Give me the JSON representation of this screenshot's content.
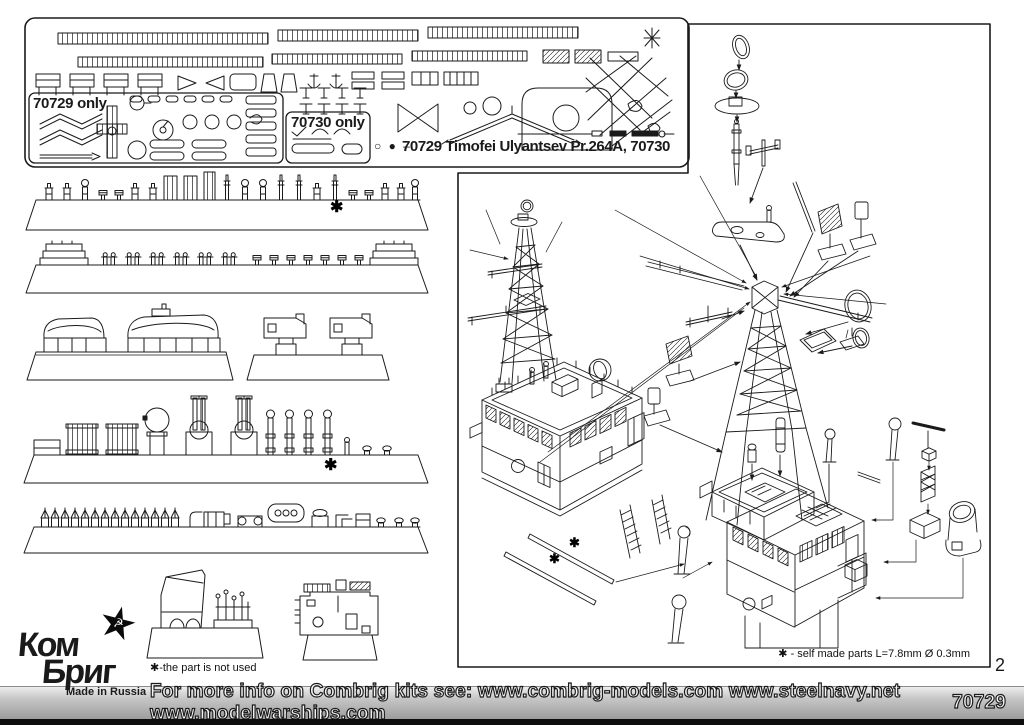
{
  "document": {
    "kit_title": "70729 Timofei Ulyantsev Pr.264A, 70730",
    "legend_symbols": "○ ● –",
    "fret": {
      "label_70729_only": "70729 only",
      "label_70730_only": "70730 only"
    },
    "notes": {
      "part_not_used": "✱-the part is not used",
      "self_made_parts": "✱ - self made parts L=7.8mm  Ø 0.3mm"
    },
    "marks": {
      "star": "✱"
    },
    "page_number": "2",
    "footer": {
      "info_text": "For more info on Combrig kits see: www.combrig-models.com www.steelnavy.net  www.modelwarships.com",
      "kit_number": "70729"
    },
    "logo": {
      "brand_line1": "Ком",
      "brand_line2": "Бриг",
      "tagline": "Made in Russia",
      "star": "★",
      "emblem": "☭"
    }
  }
}
